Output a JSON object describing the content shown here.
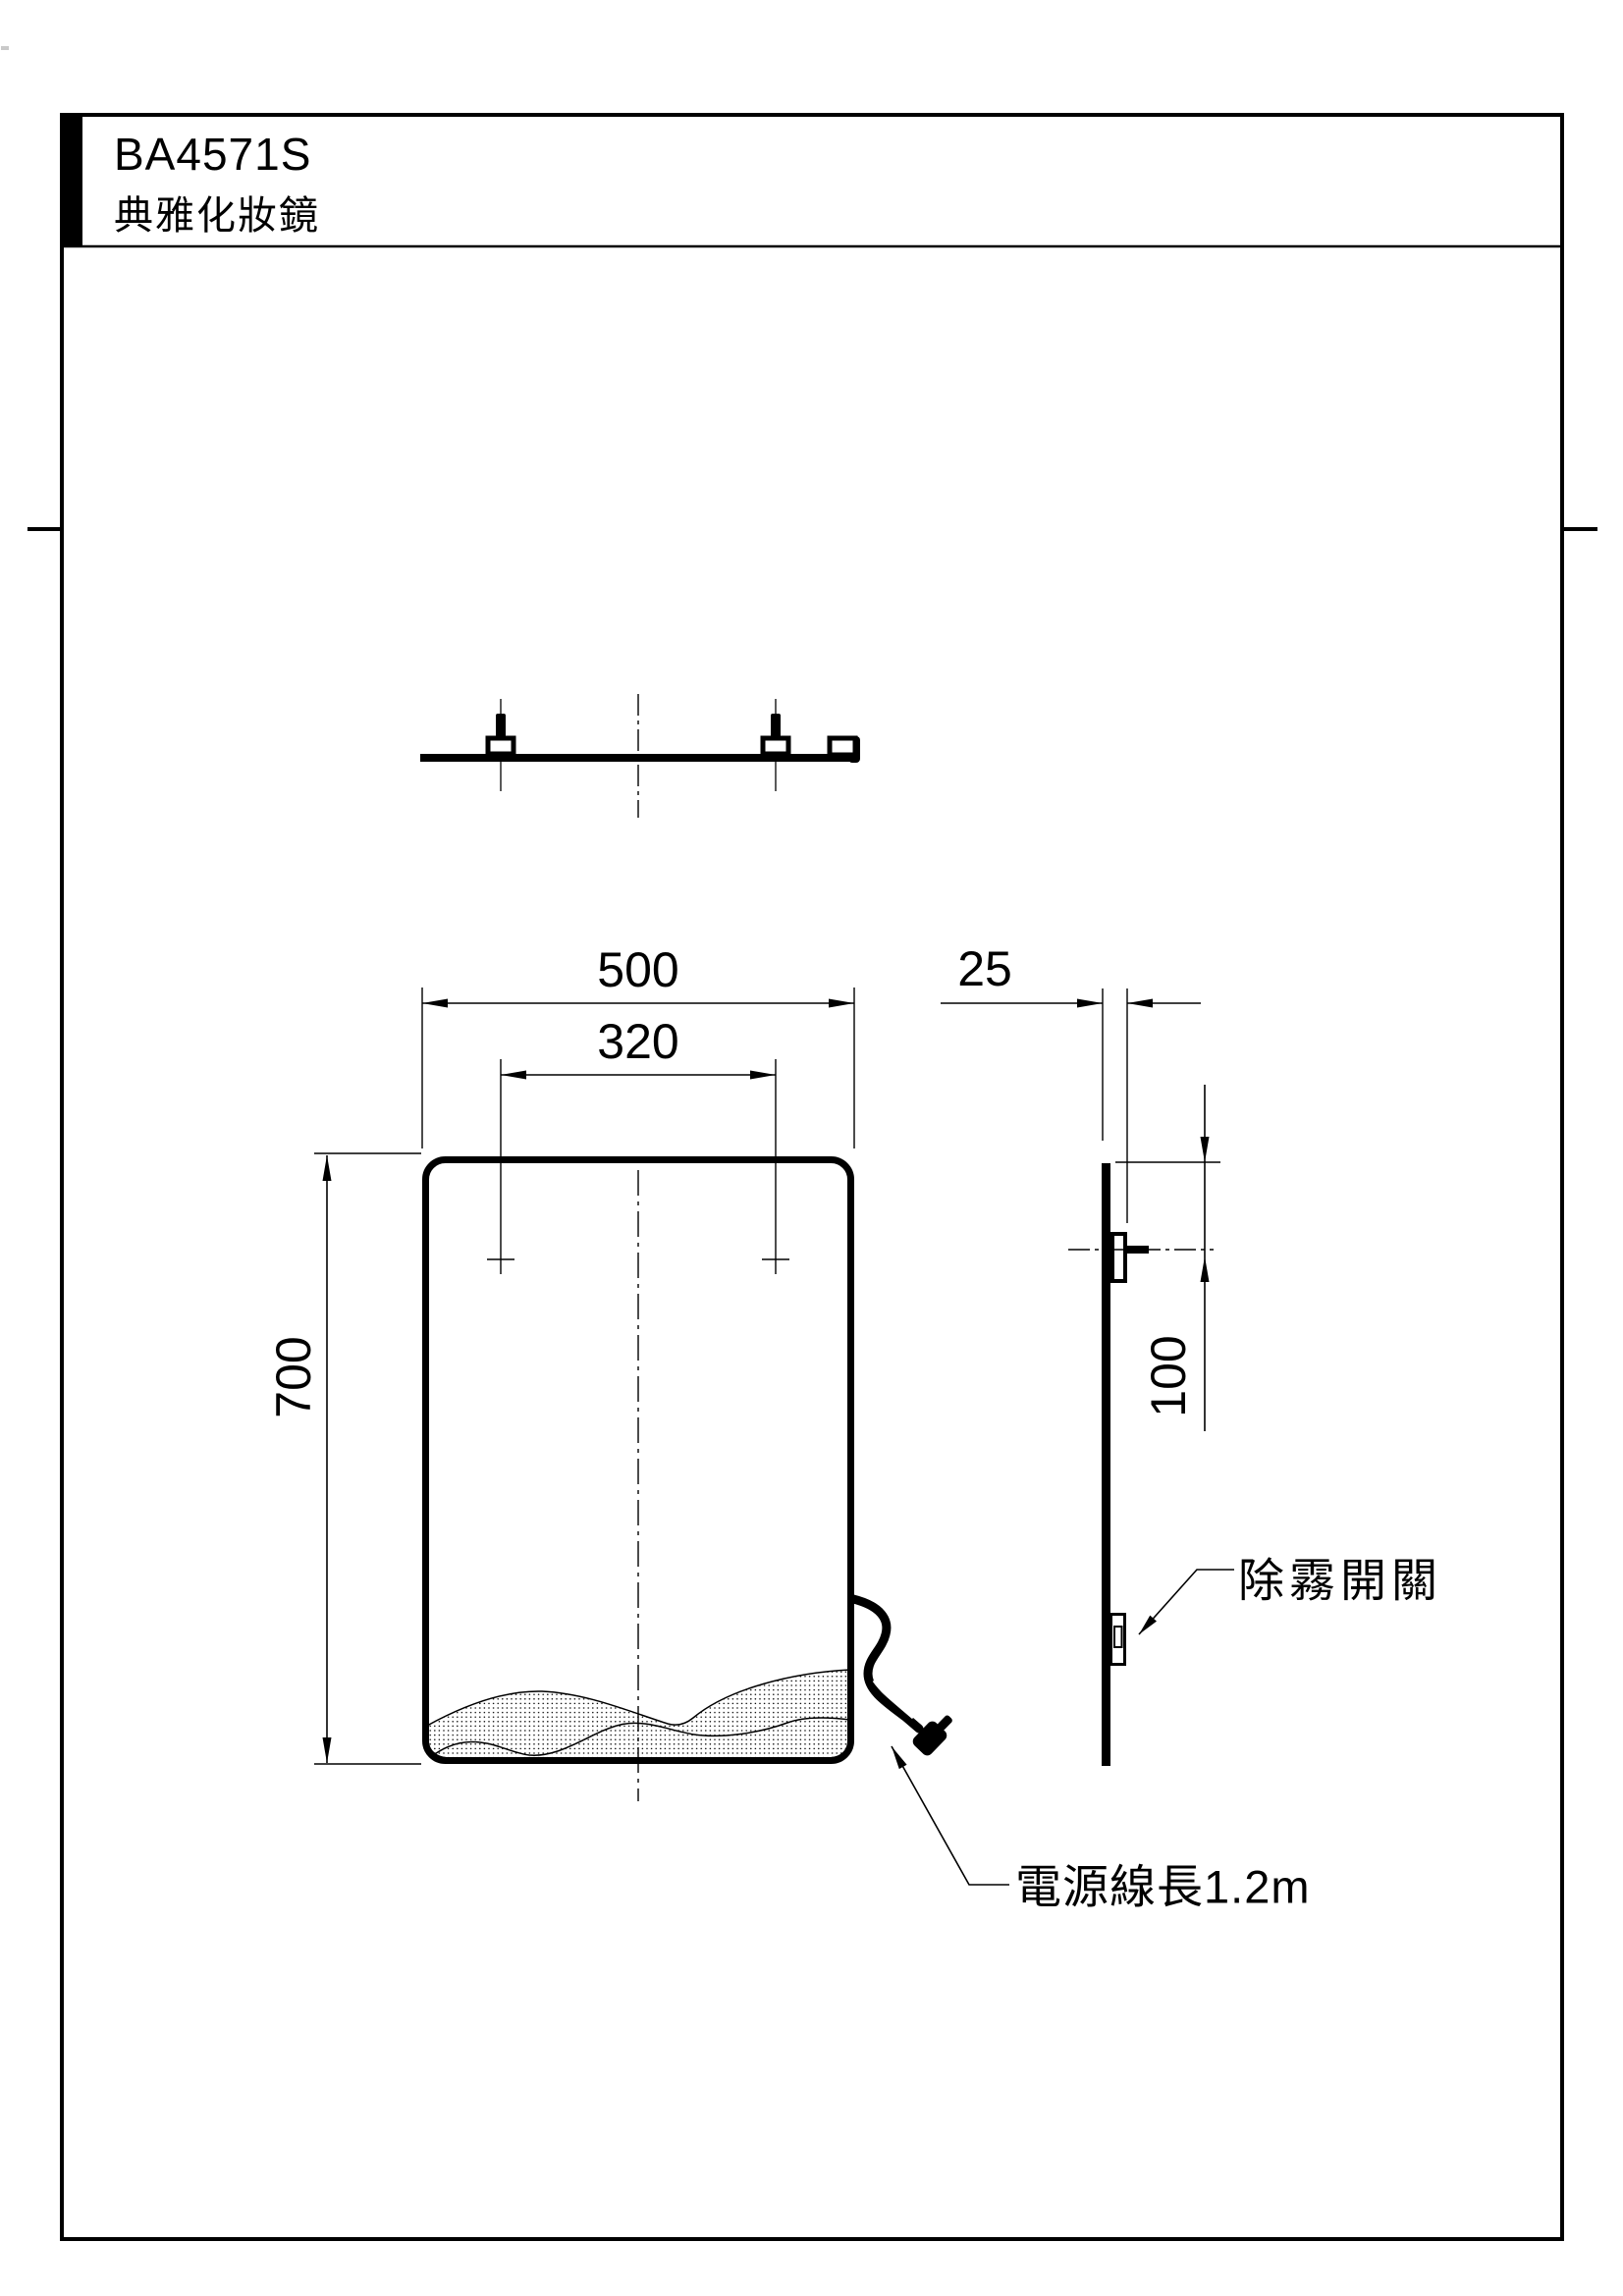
{
  "title_block": {
    "model_code": "BA4571S",
    "product_name": "典雅化妝鏡"
  },
  "dimensions": {
    "width": "500",
    "mount_spacing": "320",
    "height": "700",
    "depth": "25",
    "bracket_offset_from_top": "100"
  },
  "callouts": {
    "defog_switch": "除霧開關",
    "power_cord": "電源線長1.2m"
  },
  "colors": {
    "ink": "#000000",
    "paper": "#ffffff"
  }
}
